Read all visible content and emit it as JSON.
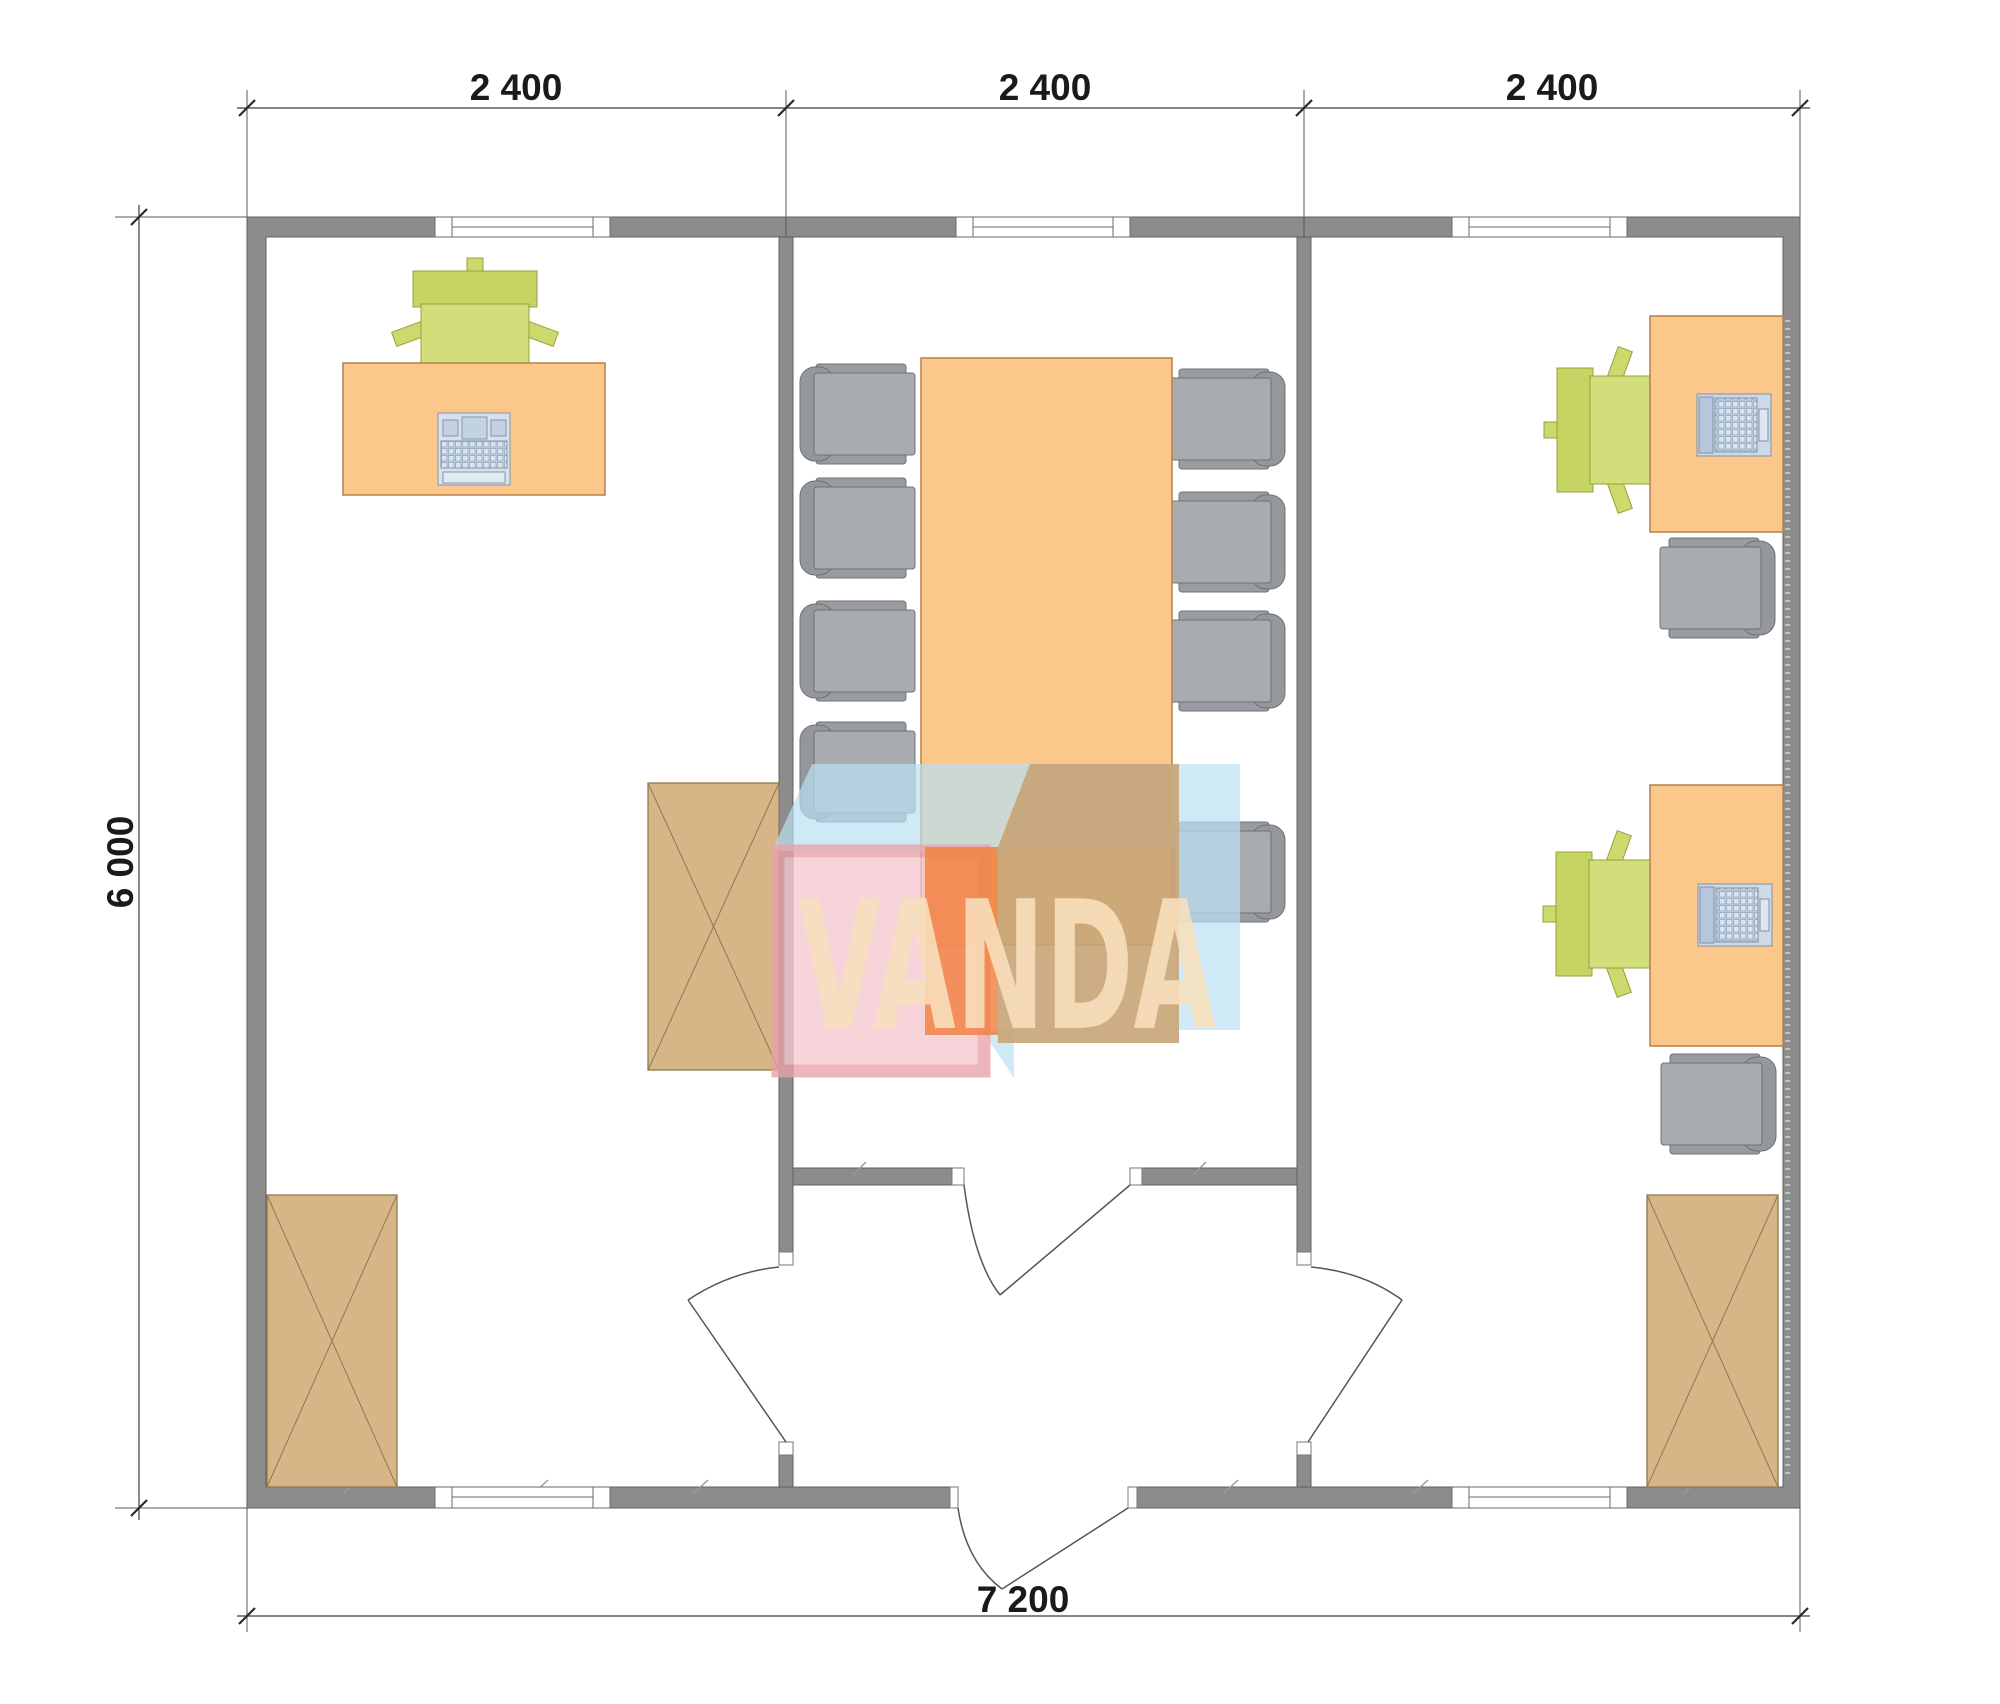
{
  "drawing": {
    "type": "architectural-floor-plan",
    "watermark": {
      "text": "VANDA"
    },
    "dimensions": {
      "top": [
        "2 400",
        "2 400",
        "2 400"
      ],
      "left": "6 000",
      "bottom": "7 200"
    },
    "colors": {
      "wall": "#8c8c8c",
      "furniture_orange": "#fbc78b",
      "chair_green": "#cdd96d",
      "chair_gray": "#a8acb0",
      "cabinet_tan": "#d6b586",
      "device_blue": "#cdd9e7",
      "watermark_blue": "#badff2",
      "watermark_pink": "#f5c9d0",
      "watermark_orange": "#f08040",
      "watermark_tan": "#c8a475"
    },
    "rooms": [
      {
        "name": "office-left",
        "furniture": [
          "desk",
          "office-chair",
          "keyboard",
          "cabinet",
          "cabinet"
        ]
      },
      {
        "name": "meeting-room",
        "furniture": [
          "conference-table",
          "8 chairs",
          "single-swing-door"
        ]
      },
      {
        "name": "office-right",
        "furniture": [
          "2 desks",
          "2 office-chairs",
          "2 laptops",
          "2 side-chairs",
          "cabinet"
        ]
      }
    ]
  }
}
